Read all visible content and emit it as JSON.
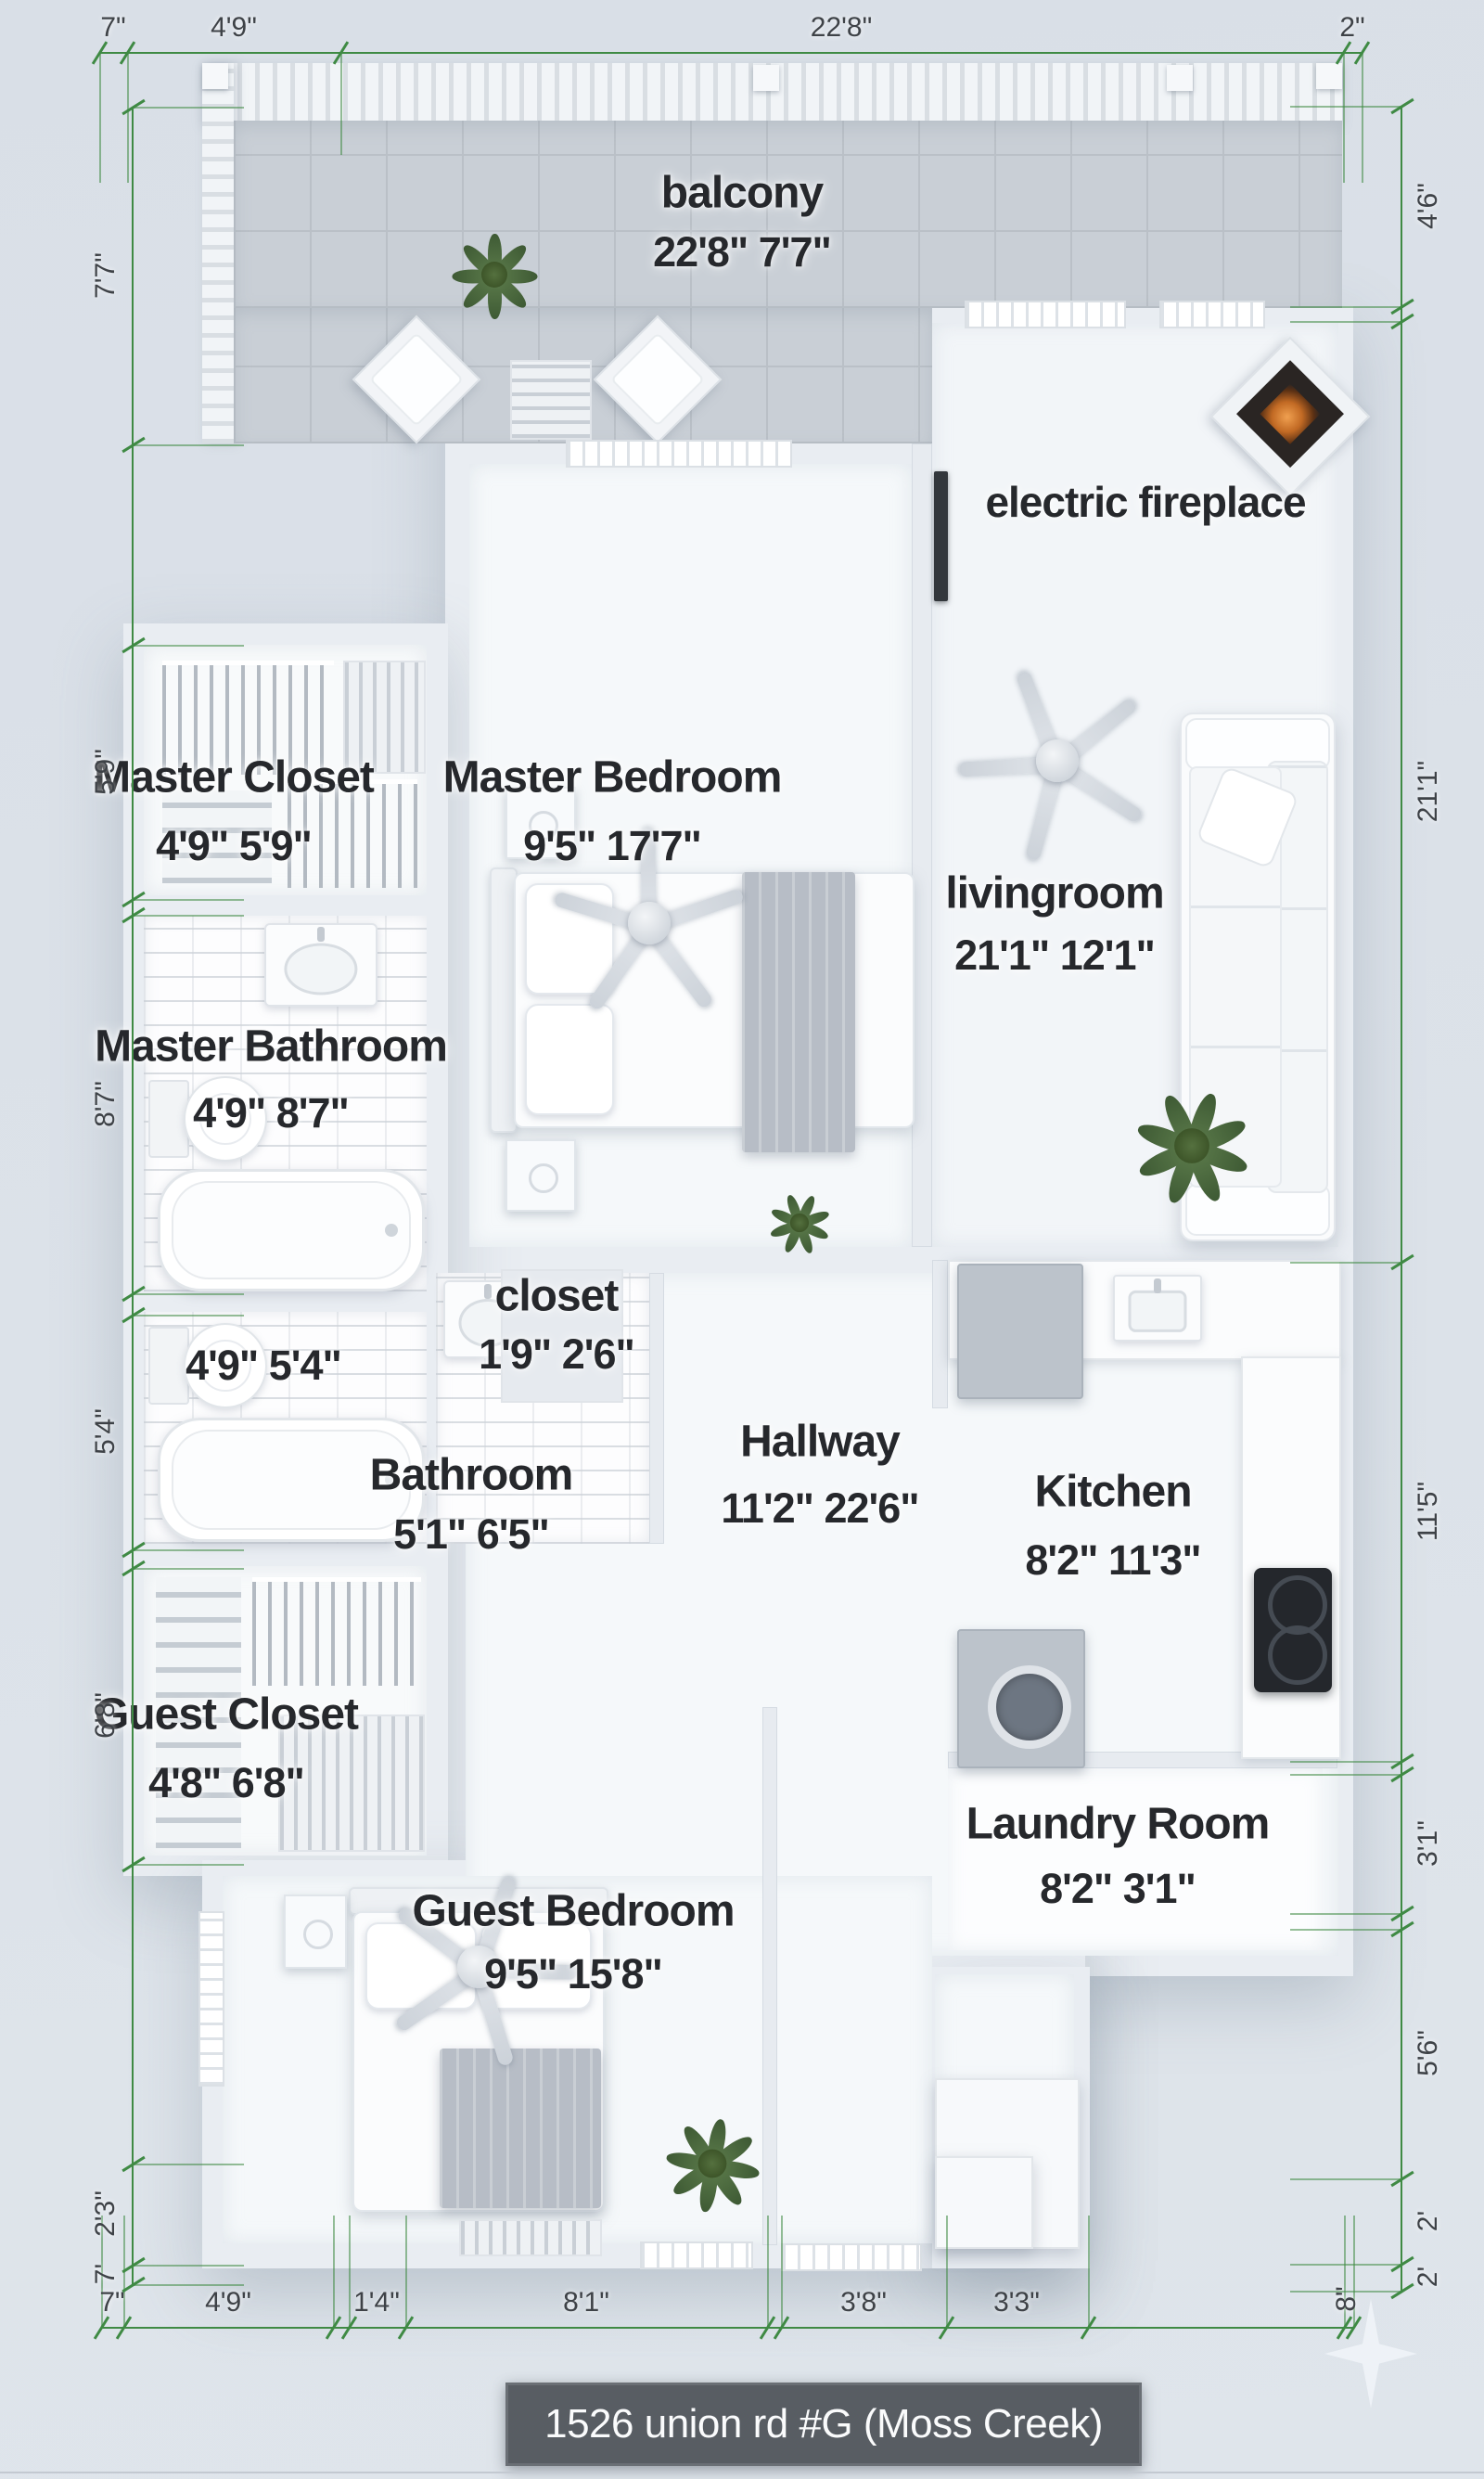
{
  "title_bar": {
    "text": "1526 union rd #G (Moss Creek)"
  },
  "rooms": {
    "balcony": {
      "name": "balcony",
      "dims": "22'8\" 7'7\""
    },
    "master_closet": {
      "name": "Master Closet",
      "dims": "4'9\" 5'9\""
    },
    "master_bedroom": {
      "name": "Master Bedroom",
      "dims": "9'5\" 17'7\""
    },
    "living_room": {
      "name": "livingroom",
      "dims": "21'1\"  12'1\""
    },
    "master_bathroom": {
      "name": "Master Bathroom",
      "dims": "4'9\" 8'7\""
    },
    "closet": {
      "name": "closet",
      "dims": "1'9\" 2'6\""
    },
    "second_bathroom": {
      "dims": "4'9\" 5'4\""
    },
    "bathroom": {
      "name": "Bathroom",
      "dims": "5'1\" 6'5\""
    },
    "hallway": {
      "name": "Hallway",
      "dims": "11'2\" 22'6\""
    },
    "kitchen": {
      "name": "Kitchen",
      "dims": "8'2\" 11'3\""
    },
    "guest_closet": {
      "name": "Guest Closet",
      "dims": "4'8\" 6'8\""
    },
    "guest_bedroom": {
      "name": "Guest Bedroom",
      "dims": "9'5\" 15'8\""
    },
    "laundry_room": {
      "name": "Laundry Room",
      "dims": "8'2\" 3'1\""
    }
  },
  "annotations": {
    "fireplace": "electric fireplace"
  },
  "measurements": {
    "top": [
      "7\"",
      "4'9\"",
      "22'8\"",
      "2\""
    ],
    "bottom": [
      "7\"",
      "4'9\"",
      "1'4\"",
      "8'1\"",
      "3'8\"",
      "3'3\"",
      "8\""
    ],
    "left": [
      "7'7\"",
      "5'9\"",
      "8'7\"",
      "5'4\"",
      "6'8\"",
      "2'3\"",
      "7'"
    ],
    "right": [
      "4'6\"",
      "21'1\"",
      "11'5\"",
      "3'1\"",
      "5'6\"",
      "2'",
      "2'"
    ]
  },
  "colors": {
    "dimension_line": "#3f8a44",
    "label_text": "#26282c",
    "title_bg": "#585d63",
    "background": "#dce2e9"
  },
  "icons": {
    "fan": "ceiling-fan-icon",
    "plant": "potted-plant-icon",
    "fireplace": "fireplace-icon",
    "sparkle": "four-point-star-icon"
  }
}
